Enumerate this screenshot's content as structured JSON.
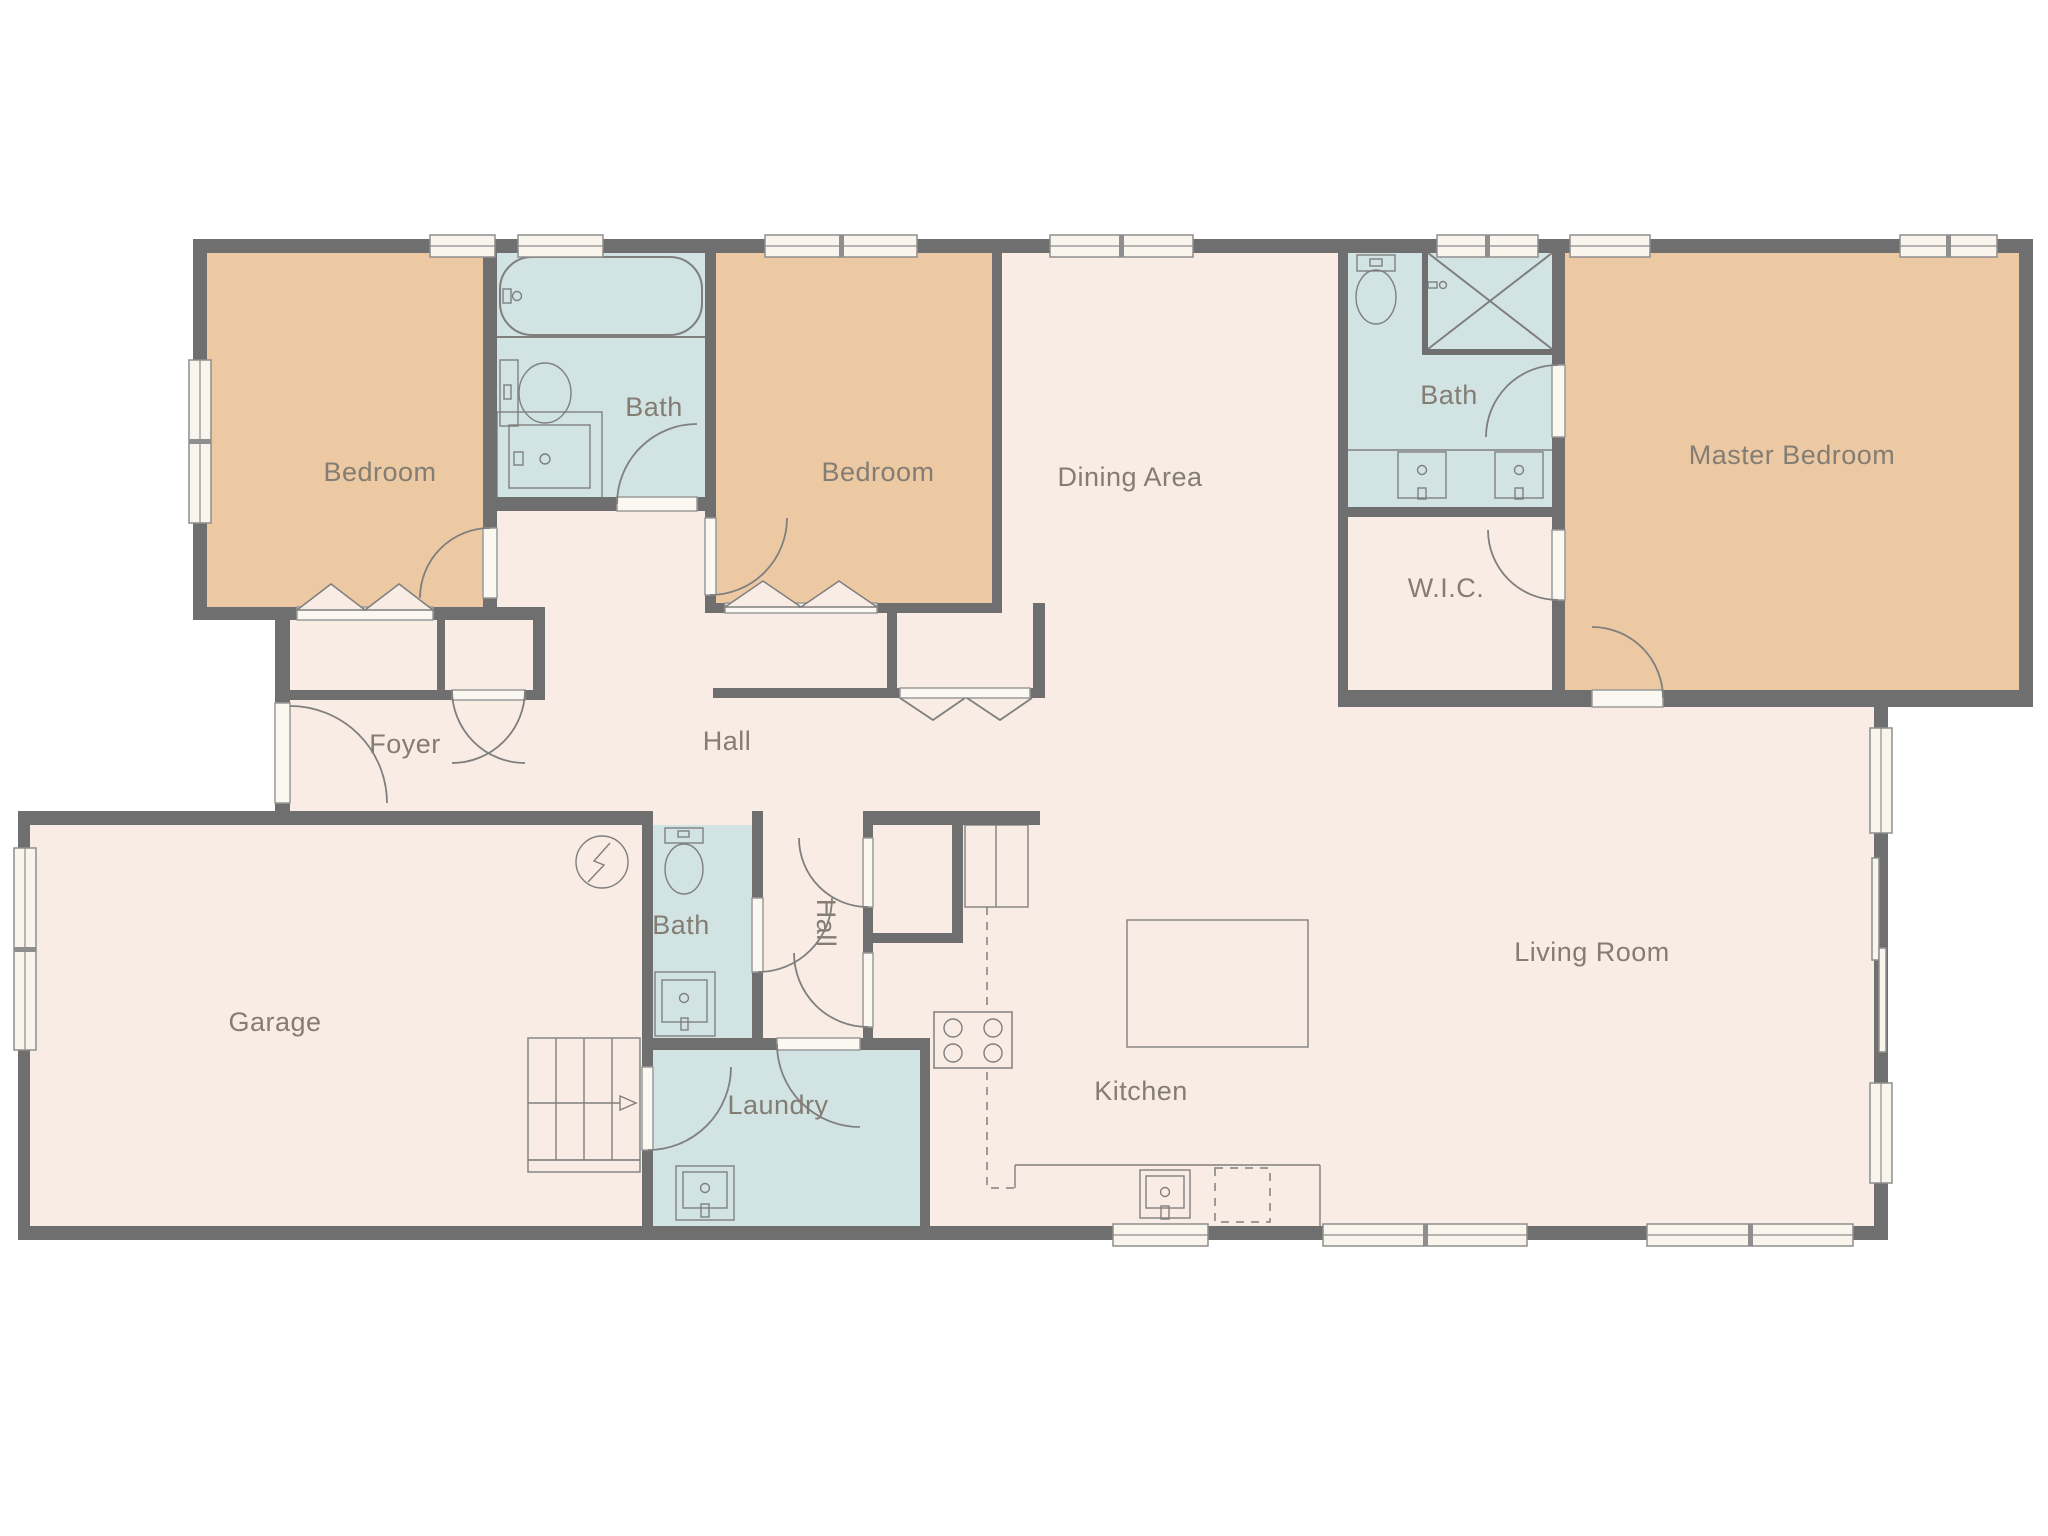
{
  "plan": {
    "type": "residential-floor-plan",
    "rooms": [
      {
        "id": "bedroom-1",
        "label": "Bedroom"
      },
      {
        "id": "bath-1",
        "label": "Bath"
      },
      {
        "id": "bedroom-2",
        "label": "Bedroom"
      },
      {
        "id": "dining-area",
        "label": "Dining Area"
      },
      {
        "id": "bath-2",
        "label": "Bath"
      },
      {
        "id": "walk-in-closet",
        "label": "W.I.C."
      },
      {
        "id": "master-bedroom",
        "label": "Master Bedroom"
      },
      {
        "id": "foyer",
        "label": "Foyer"
      },
      {
        "id": "hall",
        "label": "Hall"
      },
      {
        "id": "hall-2",
        "label": "Hall"
      },
      {
        "id": "bath-3",
        "label": "Bath"
      },
      {
        "id": "garage",
        "label": "Garage"
      },
      {
        "id": "laundry",
        "label": "Laundry"
      },
      {
        "id": "kitchen",
        "label": "Kitchen"
      },
      {
        "id": "living-room",
        "label": "Living Room"
      }
    ],
    "colors": {
      "bedroom": "#ecc9a3",
      "bathroom": "#d2e3e3",
      "floor": "#f8ece4",
      "wall": "#6f6f6f",
      "outside": "#ffffff",
      "fixture_stroke": "#7f7f7f",
      "window_fill": "#f9f4ec",
      "label_text": "#837d73"
    }
  }
}
